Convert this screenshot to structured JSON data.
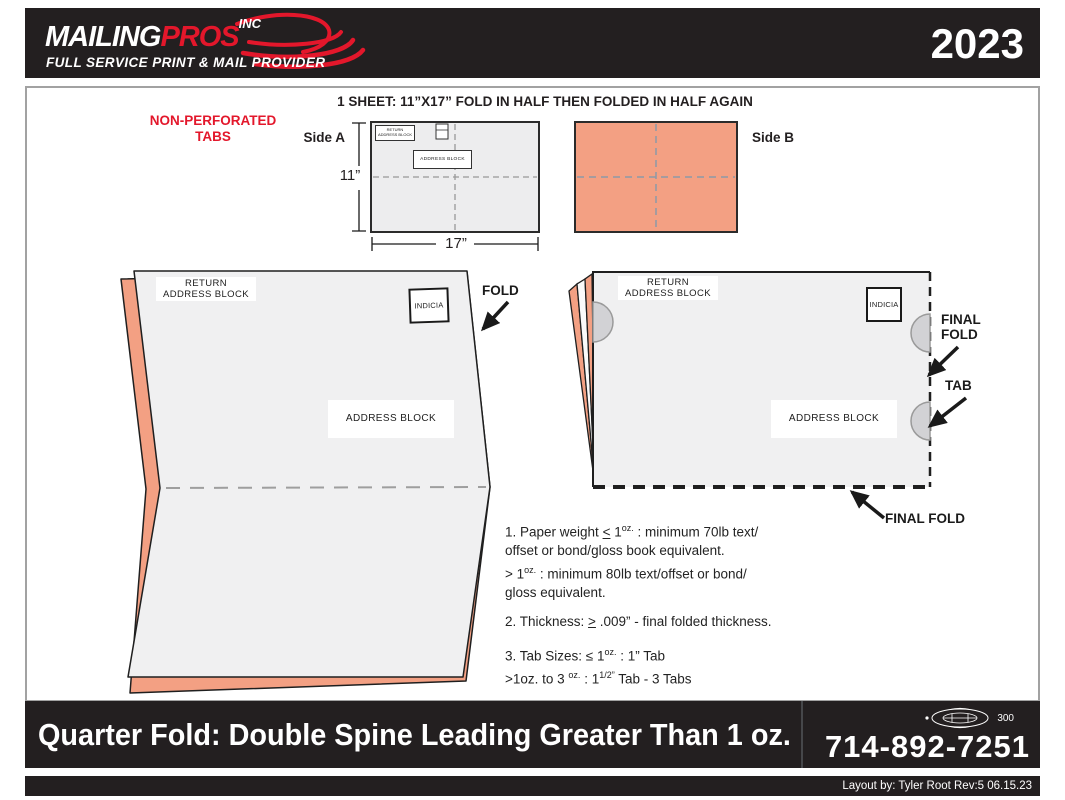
{
  "header": {
    "brand_main": "MAILING",
    "brand_accent": "PROS",
    "brand_suffix": "INC",
    "tagline": "FULL SERVICE PRINT & MAIL PROVIDER",
    "year": "2023"
  },
  "main": {
    "title": "1 SHEET: 11”X17” FOLD IN HALF THEN FOLDED IN HALF AGAIN",
    "note_line1": "NON-PERFORATED",
    "note_line2": "TABS",
    "side_a": {
      "label": "Side A",
      "height": "11”",
      "width": "17”",
      "return_block_line1": "RETURN",
      "return_block_line2": "ADDRESS BLOCK",
      "address_block": "ADDRESS BLOCK"
    },
    "side_b": {
      "label": "Side B"
    },
    "fold_step": {
      "return_line1": "RETURN",
      "return_line2": "ADDRESS BLOCK",
      "indicia": "INDICIA",
      "address_block": "ADDRESS BLOCK",
      "fold": "FOLD"
    },
    "final_step": {
      "return_line1": "RETURN",
      "return_line2": "ADDRESS BLOCK",
      "indicia": "INDICIA",
      "address_block": "ADDRESS BLOCK",
      "final_fold_line1": "FINAL",
      "final_fold_line2": "FOLD",
      "tab": "TAB",
      "final_fold_bottom": "FINAL FOLD"
    },
    "specs": {
      "lines": [
        [
          {
            "t": "1. Paper weight "
          },
          {
            "t": "<",
            "u": true
          },
          {
            "t": " 1"
          },
          {
            "t": "oz.",
            "sup": true
          },
          {
            "t": " : minimum 70lb text/"
          }
        ],
        [
          {
            "t": "offset or bond/gloss book equivalent."
          }
        ],
        [
          {
            "t": "> 1"
          },
          {
            "t": "oz.",
            "sup": true
          },
          {
            "t": " : minimum 80lb text/offset or bond/"
          }
        ],
        [
          {
            "t": "gloss equivalent."
          }
        ],
        [],
        [
          {
            "t": "2. Thickness: "
          },
          {
            "t": ">",
            "u": true
          },
          {
            "t": " .009” - final folded thickness."
          }
        ],
        [],
        [
          {
            "t": "3. Tab Sizes: ≤ 1"
          },
          {
            "t": "oz.",
            "sup": true
          },
          {
            "t": " : 1” Tab"
          }
        ],
        [
          {
            "t": ">1oz. to 3 "
          },
          {
            "t": "oz.",
            "sup": true
          },
          {
            "t": " : 1"
          },
          {
            "t": "1/2”",
            "sup": true
          },
          {
            "t": " Tab - 3 Tabs"
          }
        ]
      ]
    }
  },
  "footer": {
    "title": "Quarter Fold: Double Spine Leading Greater Than 1 oz.",
    "phone": "714-892-7251",
    "union_number": "300",
    "credit": "Layout by: Tyler Root Rev:5 06.15.23"
  },
  "colors": {
    "accent_red": "#E3172B",
    "salmon": "#F3A083",
    "panel_gray": "#F0F0F1",
    "bar_black": "#231F20"
  }
}
